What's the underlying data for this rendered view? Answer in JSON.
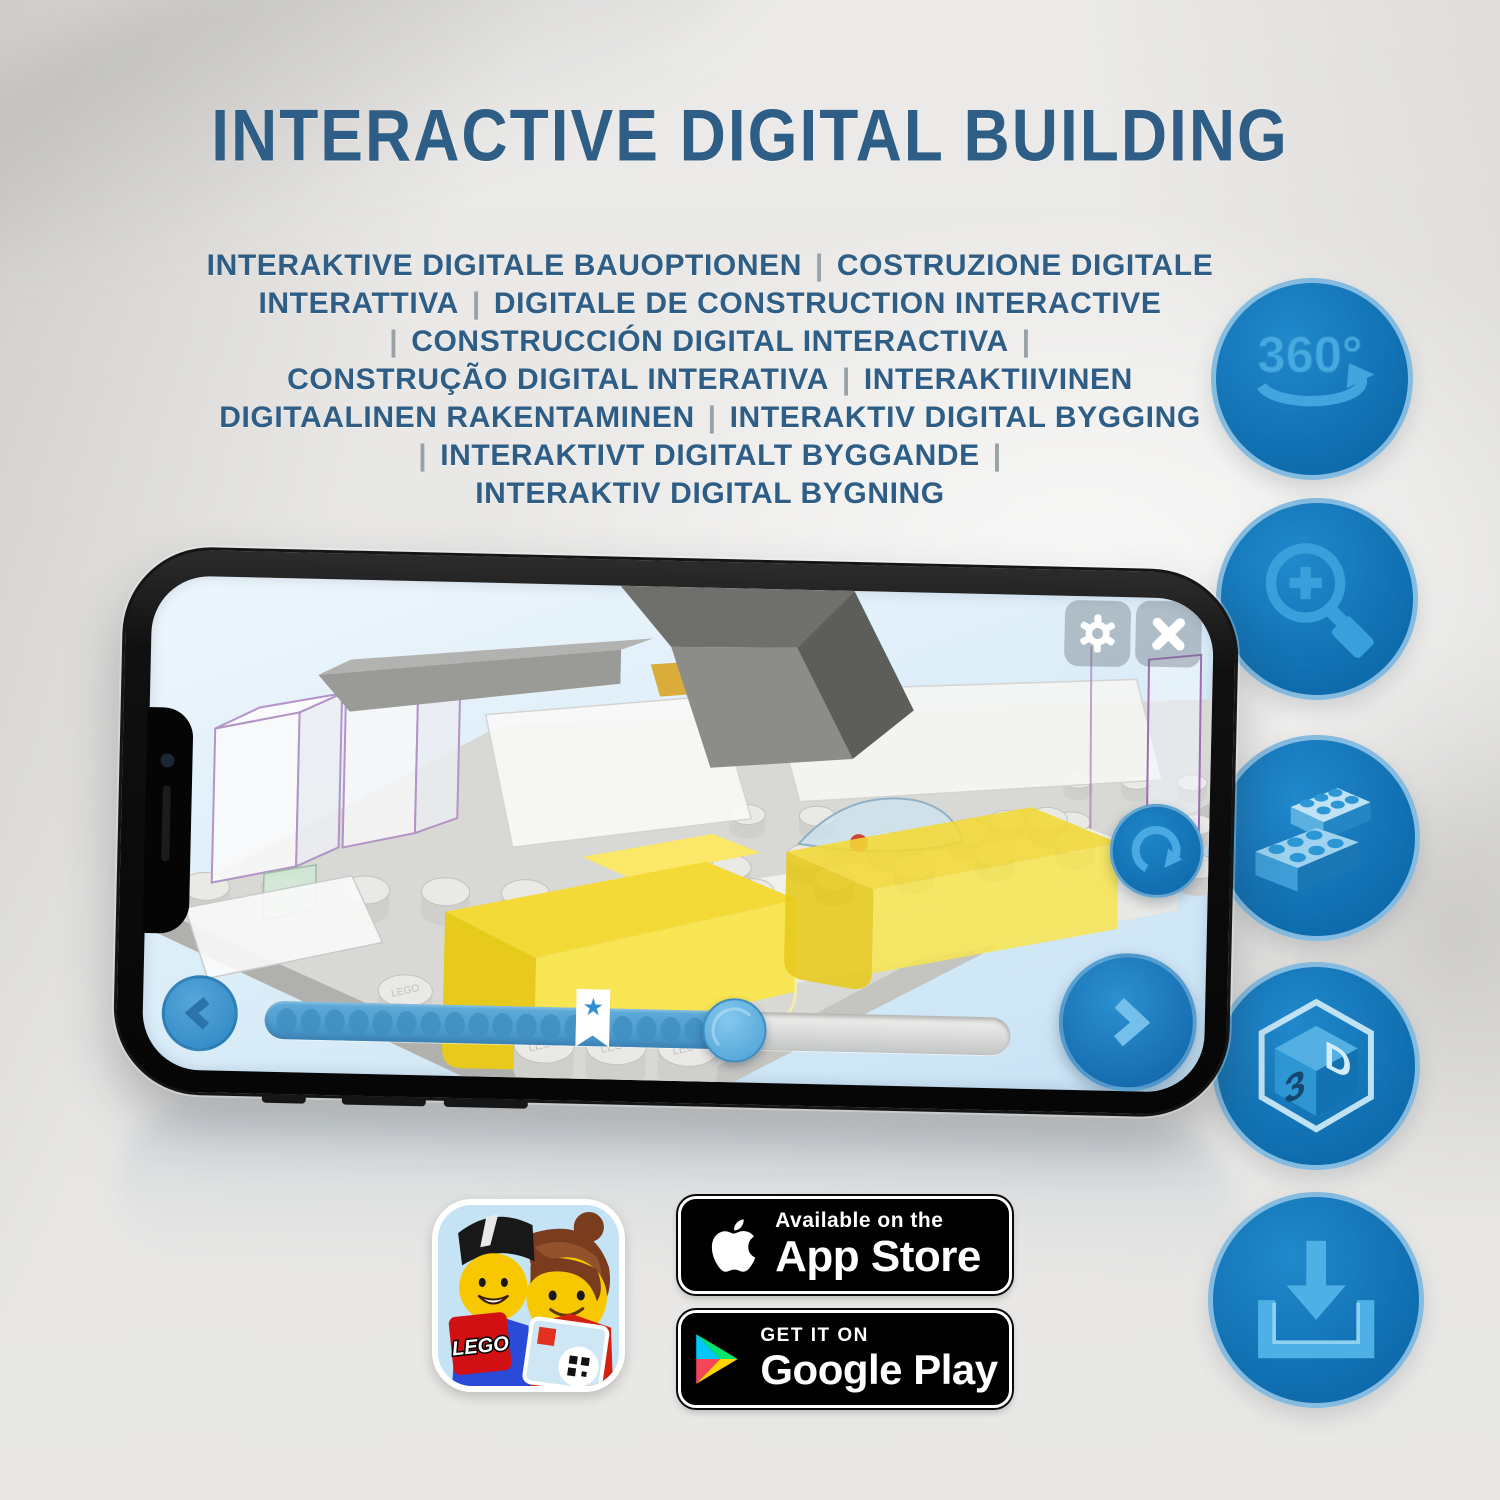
{
  "header": {
    "title": "INTERACTIVE DIGITAL BUILDING",
    "subtitle_lines": [
      "INTERAKTIVE DIGITALE BAUOPTIONEN | COSTRUZIONE DIGITALE",
      "INTERATTIVA | DIGITALE DE CONSTRUCTION INTERACTIVE",
      "| CONSTRUCCIÓN DIGITAL INTERACTIVA |",
      "CONSTRUÇÃO DIGITAL INTERATIVA | INTERAKTIIVINEN",
      "DIGITAALINEN RAKENTAMINEN | INTERAKTIV DIGITAL BYGGING",
      "| INTERAKTIVT DIGITALT BYGGANDE |",
      "INTERAKTIV DIGITAL BYGNING"
    ]
  },
  "feature_icons": [
    {
      "name": "360-rotation-icon",
      "label": "360°"
    },
    {
      "name": "zoom-in-magnifier-icon"
    },
    {
      "name": "lego-bricks-icon"
    },
    {
      "name": "3d-cube-icon",
      "faces": [
        "3",
        "D"
      ]
    },
    {
      "name": "download-icon"
    }
  ],
  "phone": {
    "screen": {
      "toolbar": {
        "icons": [
          "settings-gear-icon",
          "close-icon"
        ]
      },
      "rotate_button_icon": "rotate-cw-icon",
      "prev_button_icon": "chevron-left-icon",
      "next_button_icon": "chevron-right-icon",
      "stud_stamp": "LEGO",
      "progress": {
        "fill_percent": 63,
        "bookmark_percent": 44,
        "dot_count": 18
      }
    }
  },
  "icons": {
    "star": "★"
  },
  "badges": {
    "lego_app": {
      "logo_text": "LEGO"
    },
    "app_store": {
      "icon": "apple-icon",
      "tagline": "Available on the",
      "store_name": "App Store"
    },
    "google_play": {
      "icon": "google-play-triangle-icon",
      "tagline": "GET IT ON",
      "store_name": "Google Play"
    }
  },
  "colors": {
    "heading": "#2e5d85",
    "pipe": "#98a2a8",
    "icon_circle_blue": "#1178bb",
    "icon_glyph_blue": "#3aa0dc",
    "ui_blue": "#2f8fd0",
    "brick_yellow": "#f0d32f",
    "screen_bg": "#d9ecf8"
  }
}
